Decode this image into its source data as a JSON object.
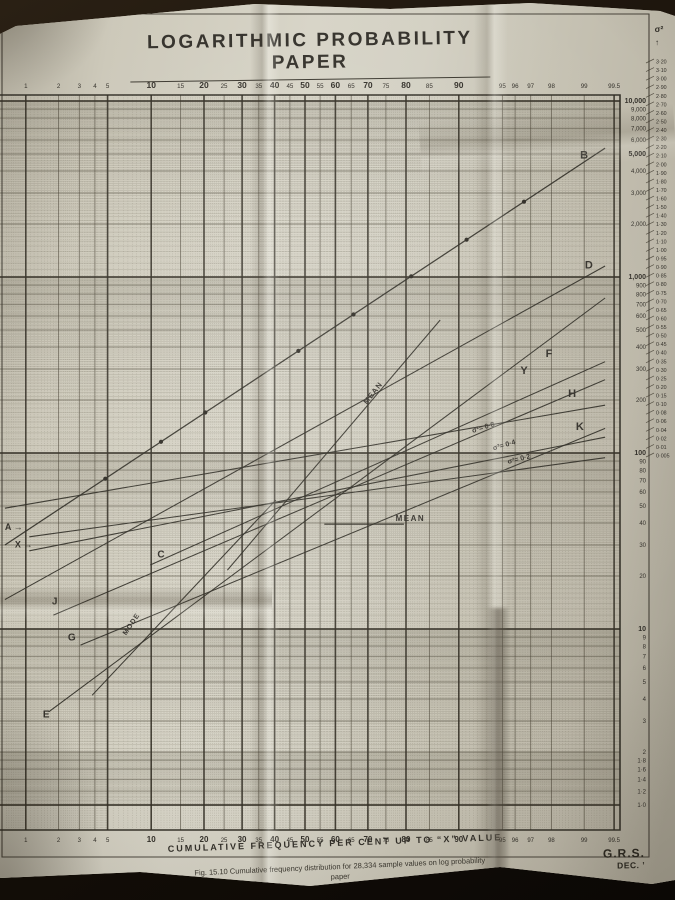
{
  "photo": {
    "background": "#17100a",
    "page": "#c9c5b7",
    "ink": "#33302a",
    "grid": "#565140"
  },
  "title": {
    "text": "LOGARITHMIC  PROBABILITY  PAPER"
  },
  "x_axis": {
    "title": "CUMULATIVE  FREQUENCY  PER  CENT  UP  TO  “X”  VALUE",
    "tick_labels": [
      {
        "p": 1,
        "t": "1",
        "big": false
      },
      {
        "p": 2,
        "t": "2",
        "big": false
      },
      {
        "p": 3,
        "t": "3",
        "big": false
      },
      {
        "p": 4,
        "t": "4",
        "big": false
      },
      {
        "p": 5,
        "t": "5",
        "big": false
      },
      {
        "p": 10,
        "t": "10",
        "big": true
      },
      {
        "p": 15,
        "t": "15",
        "big": false
      },
      {
        "p": 20,
        "t": "20",
        "big": true
      },
      {
        "p": 25,
        "t": "25",
        "big": false
      },
      {
        "p": 30,
        "t": "30",
        "big": true
      },
      {
        "p": 35,
        "t": "35",
        "big": false
      },
      {
        "p": 40,
        "t": "40",
        "big": true
      },
      {
        "p": 45,
        "t": "45",
        "big": false
      },
      {
        "p": 50,
        "t": "50",
        "big": true
      },
      {
        "p": 55,
        "t": "55",
        "big": false
      },
      {
        "p": 60,
        "t": "60",
        "big": true
      },
      {
        "p": 65,
        "t": "65",
        "big": false
      },
      {
        "p": 70,
        "t": "70",
        "big": true
      },
      {
        "p": 75,
        "t": "75",
        "big": false
      },
      {
        "p": 80,
        "t": "80",
        "big": true
      },
      {
        "p": 85,
        "t": "85",
        "big": false
      },
      {
        "p": 90,
        "t": "90",
        "big": true
      },
      {
        "p": 95,
        "t": "95",
        "big": false
      },
      {
        "p": 96,
        "t": "96",
        "big": false
      },
      {
        "p": 97,
        "t": "97",
        "big": false
      },
      {
        "p": 98,
        "t": "98",
        "big": false
      },
      {
        "p": 99,
        "t": "99",
        "big": false
      },
      {
        "p": 99.5,
        "t": "99.5",
        "big": false
      }
    ]
  },
  "y_axis": {
    "labels": [
      {
        "v": 10000,
        "t": "10,000",
        "b": true
      },
      {
        "v": 9000,
        "t": "9,000",
        "b": false
      },
      {
        "v": 8000,
        "t": "8,000",
        "b": false
      },
      {
        "v": 7000,
        "t": "7,000",
        "b": false
      },
      {
        "v": 6000,
        "t": "6,000",
        "b": false
      },
      {
        "v": 5000,
        "t": "5,000",
        "b": true
      },
      {
        "v": 4000,
        "t": "4,000",
        "b": false
      },
      {
        "v": 3000,
        "t": "3,000",
        "b": false
      },
      {
        "v": 2000,
        "t": "2,000",
        "b": false
      },
      {
        "v": 1000,
        "t": "1,000",
        "b": true
      },
      {
        "v": 900,
        "t": "900",
        "b": false
      },
      {
        "v": 800,
        "t": "800",
        "b": false
      },
      {
        "v": 700,
        "t": "700",
        "b": false
      },
      {
        "v": 600,
        "t": "600",
        "b": false
      },
      {
        "v": 500,
        "t": "500",
        "b": false
      },
      {
        "v": 400,
        "t": "400",
        "b": false
      },
      {
        "v": 300,
        "t": "300",
        "b": false
      },
      {
        "v": 200,
        "t": "200",
        "b": false
      },
      {
        "v": 100,
        "t": "100",
        "b": true
      },
      {
        "v": 90,
        "t": "90",
        "b": false
      },
      {
        "v": 80,
        "t": "80",
        "b": false
      },
      {
        "v": 70,
        "t": "70",
        "b": false
      },
      {
        "v": 60,
        "t": "60",
        "b": false
      },
      {
        "v": 50,
        "t": "50",
        "b": false
      },
      {
        "v": 40,
        "t": "40",
        "b": false
      },
      {
        "v": 30,
        "t": "30",
        "b": false
      },
      {
        "v": 20,
        "t": "20",
        "b": false
      },
      {
        "v": 10,
        "t": "10",
        "b": true
      },
      {
        "v": 9,
        "t": "9",
        "b": false
      },
      {
        "v": 8,
        "t": "8",
        "b": false
      },
      {
        "v": 7,
        "t": "7",
        "b": false
      },
      {
        "v": 6,
        "t": "6",
        "b": false
      },
      {
        "v": 5,
        "t": "5",
        "b": false
      },
      {
        "v": 4,
        "t": "4",
        "b": false
      },
      {
        "v": 3,
        "t": "3",
        "b": false
      },
      {
        "v": 2,
        "t": "2",
        "b": false
      },
      {
        "v": 1.8,
        "t": "1·8",
        "b": false
      },
      {
        "v": 1.6,
        "t": "1·6",
        "b": false
      },
      {
        "v": 1.4,
        "t": "1·4",
        "b": false
      },
      {
        "v": 1.2,
        "t": "1·2",
        "b": false
      },
      {
        "v": 1.0,
        "t": "1·0",
        "b": false
      }
    ]
  },
  "sigma_scale": {
    "title": "σ²",
    "arrow": "↑",
    "values": [
      "3·20",
      "3·10",
      "3·00",
      "2·90",
      "2·80",
      "2·70",
      "2·60",
      "2·50",
      "2·40",
      "2·30",
      "2·20",
      "2·10",
      "2·00",
      "1·90",
      "1·80",
      "1·70",
      "1·60",
      "1·50",
      "1·40",
      "1·30",
      "1·20",
      "1·10",
      "1·00",
      "0·95",
      "0·90",
      "0·85",
      "0·80",
      "0·75",
      "0·70",
      "0·65",
      "0·60",
      "0·55",
      "0·50",
      "0·45",
      "0·40",
      "0·35",
      "0·30",
      "0·25",
      "0·20",
      "0·15",
      "0·10",
      "0·08",
      "0·06",
      "0·04",
      "0·02",
      "0·01",
      "0·005"
    ]
  },
  "chart_data": {
    "type": "line",
    "title": "LOGARITHMIC PROBABILITY PAPER",
    "xlabel": "CUMULATIVE FREQUENCY PER CENT UP TO \"X\" VALUE",
    "x_scale": "normal-probability",
    "y_scale": "log",
    "ylim": [
      1,
      10000
    ],
    "series": [
      {
        "name": "B",
        "points_pv": [
          [
            0.62,
            30
          ],
          [
            99.38,
            5400
          ]
        ],
        "markers_percent": [
          4.8,
          11.5,
          20.3,
          47.8,
          65.7,
          81.2,
          91.1,
          96.6
        ],
        "width": 1.25
      },
      {
        "name": "D",
        "points_pv": [
          [
            0.62,
            14.7
          ],
          [
            99.38,
            1155
          ]
        ]
      },
      {
        "name": "E",
        "points_pv": [
          [
            1.63,
            3.38
          ],
          [
            99.38,
            760
          ]
        ]
      },
      {
        "name": "C-F",
        "points_pv": [
          [
            9.85,
            23.1
          ],
          [
            99.38,
            330
          ]
        ]
      },
      {
        "name": "J-Y",
        "points_pv": [
          [
            1.8,
            12.0
          ],
          [
            99.38,
            261
          ]
        ]
      },
      {
        "name": "H (sigma2=0.8)",
        "points_pv": [
          [
            0.62,
            48.6
          ],
          [
            99.38,
            187
          ]
        ]
      },
      {
        "name": "G",
        "points_pv": [
          [
            3.07,
            8.1
          ],
          [
            99.38,
            138
          ]
        ]
      },
      {
        "name": "X-K (sigma2=0.4)",
        "points_pv": [
          [
            1.08,
            27.8
          ],
          [
            99.38,
            123
          ]
        ]
      },
      {
        "name": "A (sigma2=0.2)",
        "points_pv": [
          [
            1.08,
            33.4
          ],
          [
            99.38,
            94
          ]
        ]
      },
      {
        "name": "mean-locus",
        "points_pv": [
          [
            25.9,
            21.6
          ],
          [
            87.0,
            570
          ]
        ]
      },
      {
        "name": "mode-locus",
        "points_pv": [
          [
            3.8,
            4.2
          ],
          [
            40.4,
            54
          ]
        ]
      },
      {
        "name": "mean-horizontal",
        "points_pv": [
          [
            56.4,
            39.4
          ],
          [
            79.5,
            39.4
          ]
        ]
      }
    ],
    "annotations": [
      {
        "t": "B",
        "p": 99.0,
        "v": 4700,
        "fs": 11
      },
      {
        "t": "D",
        "p": 99.1,
        "v": 1120,
        "fs": 11
      },
      {
        "t": "F",
        "p": 97.9,
        "v": 350,
        "fs": 11
      },
      {
        "t": "Y",
        "p": 96.6,
        "v": 282,
        "fs": 11
      },
      {
        "t": "H",
        "p": 98.7,
        "v": 208,
        "fs": 11
      },
      {
        "t": "K",
        "p": 98.9,
        "v": 135,
        "fs": 11
      },
      {
        "t": "A →",
        "p": 0.62,
        "v": 36.5,
        "fs": 9,
        "anchor": "start"
      },
      {
        "t": "X →",
        "p": 0.78,
        "v": 29,
        "fs": 9,
        "anchor": "start"
      },
      {
        "t": "C",
        "p": 11.5,
        "v": 25.5,
        "fs": 10
      },
      {
        "t": "J",
        "p": 1.85,
        "v": 13.8,
        "fs": 10
      },
      {
        "t": "G",
        "p": 2.6,
        "v": 8.6,
        "fs": 10
      },
      {
        "t": "E",
        "p": 1.55,
        "v": 3.15,
        "fs": 10
      },
      {
        "t": "MEAN",
        "p": 72,
        "v": 215,
        "rot": -52,
        "fs": 7.5,
        "ls": 1
      },
      {
        "t": "MEAN",
        "p": 81,
        "v": 41,
        "fs": 8,
        "ls": 1.5
      },
      {
        "t": "MODE",
        "p": 7.6,
        "v": 10.5,
        "rot": -56,
        "fs": 7,
        "ls": 1
      },
      {
        "t": "σ²= 0·8",
        "p": 93.2,
        "v": 136,
        "rot": -17,
        "fs": 7
      },
      {
        "t": "σ²= 0·4",
        "p": 95.2,
        "v": 108,
        "rot": -16,
        "fs": 7
      },
      {
        "t": "σ²= 0·2",
        "p": 96.3,
        "v": 90,
        "rot": -14,
        "fs": 7
      }
    ]
  },
  "caption": {
    "line1": "Fig. 15.10   Cumulative frequency distribution for 28,334 sample values on log probability",
    "line2": "paper"
  },
  "credit": {
    "initials": "G.R.S.",
    "date": "DEC. ’"
  }
}
